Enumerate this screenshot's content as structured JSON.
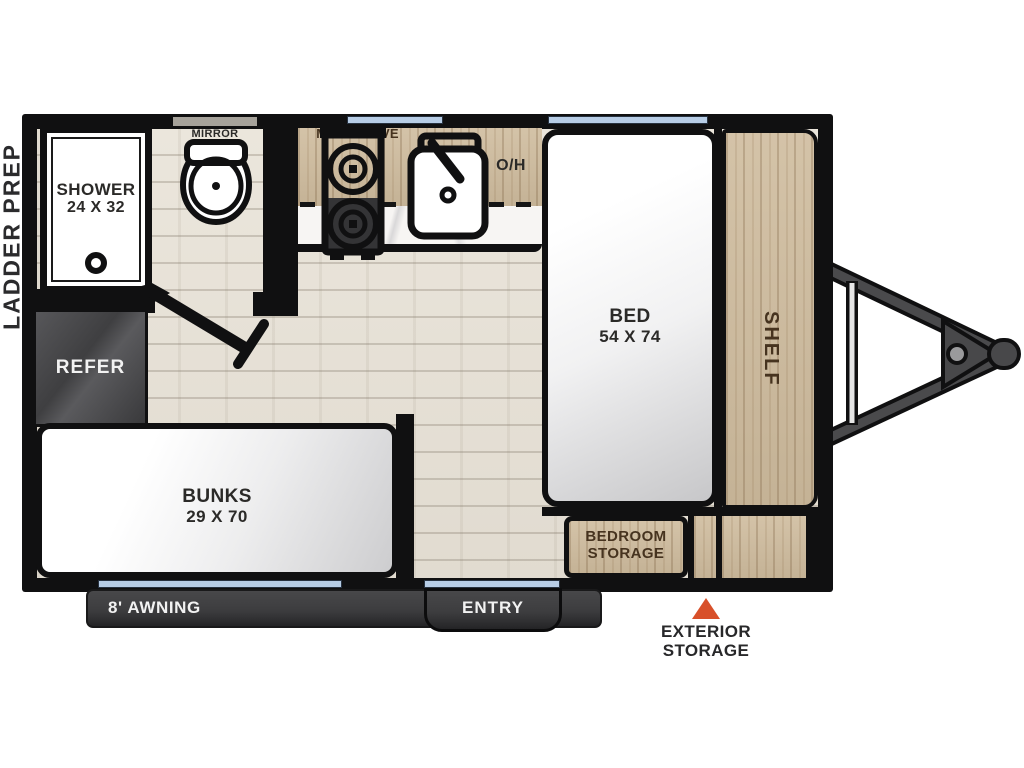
{
  "colors": {
    "wall": "#101011",
    "floor_wood": "#e8e3d9",
    "cabinet_wood": "#cfbc9e",
    "counter_marble": "#f7f5f3",
    "appliance_dark": "#3d3d3f",
    "window_glass": "#b7cde6",
    "marker_orange": "#d8502a",
    "label_dark": "#2b2a28",
    "label_brown": "#46331f",
    "label_white": "#f2f2f2"
  },
  "exterior": {
    "ladder_prep": "LADDER PREP",
    "awning": "8' AWNING",
    "entry": "ENTRY",
    "exterior_storage": [
      "EXTERIOR",
      "STORAGE"
    ]
  },
  "bathroom": {
    "shower": [
      "SHOWER",
      "24 X 32"
    ],
    "mirror": "MIRROR"
  },
  "kitchen": {
    "microwave": "MICROWAVE",
    "overhead_cabinet": "O/H"
  },
  "bedroom": {
    "bed": [
      "BED",
      "54 X 74"
    ],
    "shelf": "SHELF",
    "storage": [
      "BEDROOM",
      "STORAGE"
    ]
  },
  "living_area": {
    "refrigerator": "REFER",
    "bunks": [
      "BUNKS",
      "29 X 70"
    ]
  }
}
